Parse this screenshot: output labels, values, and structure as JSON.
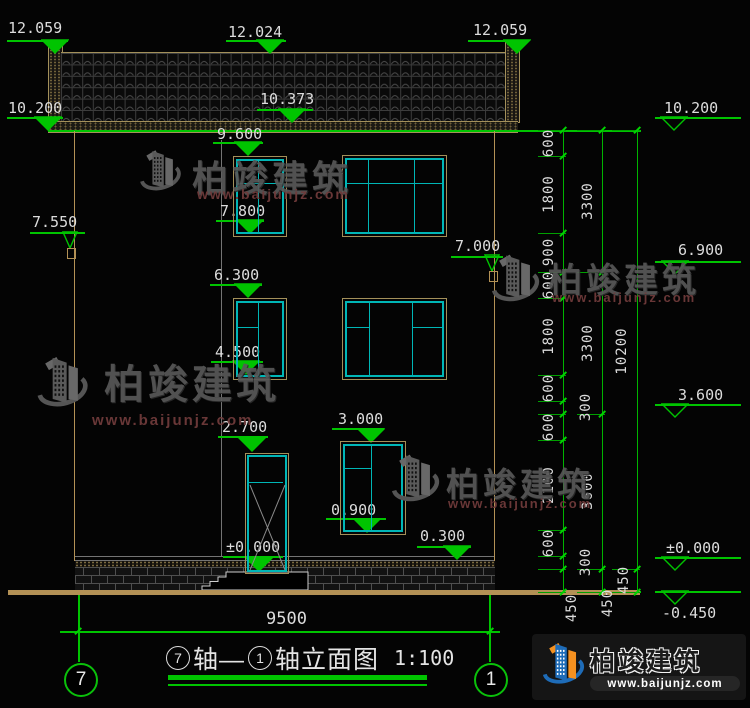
{
  "drawing": {
    "title": {
      "axis_left_num": "7",
      "axis_join": "轴—",
      "axis_right_num": "1",
      "suffix": "轴立面图",
      "scale": "1:100"
    },
    "axis_bubbles": {
      "left": "7",
      "right": "1"
    },
    "bottom_dimension": {
      "total": "9500"
    },
    "logo": {
      "name": "柏竣建筑",
      "url": "www.baijunjz.com"
    },
    "colors": {
      "dim_green": "#00c400",
      "cad_teal": "#00b6b6",
      "frame_tan": "#a3905a",
      "text_white": "#dcdcdc",
      "watermark_gray": "#585858",
      "watermark_red": "#6f3a3a",
      "logo_blue": "#1e6cb8",
      "logo_orange": "#f59120"
    }
  },
  "elevation_markers": [
    {
      "label": "12.059",
      "variant": "filled",
      "tx": 8,
      "ty": 20,
      "lx1": 7,
      "lx2": 68,
      "ly": 40,
      "cx": 55,
      "tip": 53
    },
    {
      "label": "12.024",
      "variant": "filled",
      "tx": 228,
      "ty": 24,
      "lx1": 226,
      "lx2": 286,
      "ly": 40,
      "cx": 270,
      "tip": 53
    },
    {
      "label": "12.059",
      "variant": "filled",
      "tx": 473,
      "ty": 22,
      "lx1": 468,
      "lx2": 526,
      "ly": 40,
      "cx": 517,
      "tip": 53
    },
    {
      "label": "10.200",
      "variant": "filled",
      "tx": 8,
      "ty": 100,
      "lx1": 7,
      "lx2": 63,
      "ly": 117,
      "cx": 48,
      "tip": 130
    },
    {
      "label": "10.373",
      "variant": "filled",
      "tx": 260,
      "ty": 91,
      "lx1": 257,
      "lx2": 313,
      "ly": 109,
      "cx": 292,
      "tip": 122
    },
    {
      "label": "9.600",
      "variant": "filled",
      "tx": 217,
      "ty": 126,
      "lx1": 213,
      "lx2": 263,
      "ly": 142,
      "cx": 248,
      "tip": 155
    },
    {
      "label": "7.800",
      "variant": "filled",
      "tx": 220,
      "ty": 203,
      "lx1": 216,
      "lx2": 264,
      "ly": 220,
      "cx": 250,
      "tip": 233
    },
    {
      "label": "6.300",
      "variant": "filled",
      "tx": 214,
      "ty": 267,
      "lx1": 210,
      "lx2": 262,
      "ly": 284,
      "cx": 248,
      "tip": 297
    },
    {
      "label": "4.500",
      "variant": "filled",
      "tx": 215,
      "ty": 344,
      "lx1": 211,
      "lx2": 263,
      "ly": 361,
      "cx": 246,
      "tip": 374
    },
    {
      "label": "2.700",
      "variant": "filled",
      "tx": 222,
      "ty": 419,
      "lx1": 218,
      "lx2": 268,
      "ly": 436,
      "cx": 252,
      "tip": 451
    },
    {
      "label": "3.000",
      "variant": "filled",
      "tx": 338,
      "ty": 411,
      "lx1": 332,
      "lx2": 384,
      "ly": 428,
      "cx": 371,
      "tip": 442
    },
    {
      "label": "0.900",
      "variant": "filled",
      "tx": 331,
      "ty": 502,
      "lx1": 326,
      "lx2": 386,
      "ly": 518,
      "cx": 367,
      "tip": 532
    },
    {
      "label": "0.300",
      "variant": "filled",
      "tx": 420,
      "ty": 528,
      "lx1": 417,
      "lx2": 471,
      "ly": 546,
      "cx": 457,
      "tip": 559
    },
    {
      "label": "±0.000",
      "variant": "filled",
      "tx": 226,
      "ty": 539,
      "lx1": 223,
      "lx2": 283,
      "ly": 556,
      "cx": 259,
      "tip": 571
    },
    {
      "label": "7.550",
      "variant": "narrow",
      "tx": 32,
      "ty": 214,
      "lx1": 30,
      "lx2": 85,
      "ly": 232,
      "cx": 70,
      "tip": 248,
      "box": true
    },
    {
      "label": "7.000",
      "variant": "narrow",
      "tx": 455,
      "ty": 238,
      "lx1": 451,
      "lx2": 503,
      "ly": 256,
      "cx": 492,
      "tip": 271,
      "box": true
    },
    {
      "label": "10.200",
      "variant": "hollow",
      "tx": 664,
      "ty": 100,
      "lx1": 655,
      "lx2": 741,
      "ly": 117,
      "cx": 674,
      "tip": 130
    },
    {
      "label": "6.900",
      "variant": "hollow",
      "tx": 678,
      "ty": 242,
      "lx1": 655,
      "lx2": 741,
      "ly": 261,
      "cx": 675,
      "tip": 274
    },
    {
      "label": "3.600",
      "variant": "hollow",
      "tx": 678,
      "ty": 387,
      "lx1": 655,
      "lx2": 741,
      "ly": 404,
      "cx": 675,
      "tip": 417
    },
    {
      "label": "±0.000",
      "variant": "hollow",
      "tx": 666,
      "ty": 540,
      "lx1": 655,
      "lx2": 741,
      "ly": 557,
      "cx": 675,
      "tip": 570
    },
    {
      "label": "-0.450",
      "variant": "hollow",
      "tx": 662,
      "ty": 607,
      "lx1": 655,
      "lx2": 741,
      "ly": 591,
      "cx": 675,
      "tip": 604,
      "below": true
    }
  ],
  "dimension_chains": {
    "lines": [
      {
        "x": 563,
        "y1": 130,
        "y2": 592,
        "boundaries": [
          130,
          156,
          233,
          272,
          298,
          375,
          401,
          414,
          440,
          530,
          556,
          569,
          592
        ]
      },
      {
        "x": 602,
        "y1": 130,
        "y2": 592,
        "boundaries": [
          130,
          272,
          414,
          569,
          592
        ]
      },
      {
        "x": 637,
        "y1": 130,
        "y2": 592,
        "boundaries": [
          130,
          569,
          592
        ]
      }
    ],
    "labels": [
      {
        "t": "600",
        "x": 549,
        "y": 143
      },
      {
        "t": "1800",
        "x": 549,
        "y": 194
      },
      {
        "t": "900",
        "x": 549,
        "y": 252
      },
      {
        "t": "600",
        "x": 549,
        "y": 285
      },
      {
        "t": "1800",
        "x": 549,
        "y": 336
      },
      {
        "t": "600",
        "x": 549,
        "y": 388
      },
      {
        "t": "300",
        "x": 586,
        "y": 407
      },
      {
        "t": "600",
        "x": 549,
        "y": 427
      },
      {
        "t": "2100",
        "x": 549,
        "y": 485
      },
      {
        "t": "600",
        "x": 549,
        "y": 543
      },
      {
        "t": "300",
        "x": 586,
        "y": 562
      },
      {
        "t": "450",
        "x": 572,
        "y": 608
      },
      {
        "t": "3300",
        "x": 588,
        "y": 201
      },
      {
        "t": "3300",
        "x": 588,
        "y": 343
      },
      {
        "t": "3600",
        "x": 588,
        "y": 491
      },
      {
        "t": "450",
        "x": 608,
        "y": 603
      },
      {
        "t": "10200",
        "x": 622,
        "y": 351
      },
      {
        "t": "450",
        "x": 624,
        "y": 580
      }
    ]
  },
  "green_lines": [
    {
      "x": 48,
      "y": 130,
      "w": 593,
      "h": 1.5
    },
    {
      "x": 538,
      "y": 591,
      "w": 103,
      "h": 1.5
    },
    {
      "x": 60,
      "y": 631,
      "w": 440,
      "h": 1.5
    },
    {
      "x": 78,
      "y": 595,
      "w": 1.5,
      "h": 67
    },
    {
      "x": 489,
      "y": 595,
      "w": 1.5,
      "h": 67
    },
    {
      "x": 168,
      "y": 675,
      "w": 259,
      "h": 5
    },
    {
      "x": 168,
      "y": 684,
      "w": 259,
      "h": 2
    }
  ],
  "white_lines": [
    {
      "x": 75,
      "y": 556,
      "w": 420,
      "h": 1.2
    },
    {
      "x": 75,
      "y": 560,
      "w": 420,
      "h": 1.2
    },
    {
      "x": 221,
      "y": 140,
      "w": 1,
      "h": 416
    }
  ],
  "tan_lines": [
    {
      "x": 74,
      "y": 131,
      "w": 1.2,
      "h": 430
    },
    {
      "x": 494,
      "y": 131,
      "w": 1.2,
      "h": 430
    },
    {
      "x": 8,
      "y": 590,
      "w": 632,
      "h": 4.5
    }
  ],
  "dim_slashes": [
    {
      "x": 78,
      "y": 631
    },
    {
      "x": 490,
      "y": 631
    }
  ],
  "windows": [
    {
      "frame": [
        233,
        156,
        52,
        79
      ],
      "lines": [
        [
          258,
          159,
          1.4,
          73
        ],
        [
          236,
          183,
          46,
          1.4
        ]
      ]
    },
    {
      "frame": [
        342,
        155,
        103,
        80
      ],
      "lines": [
        [
          368,
          158,
          1.4,
          74
        ],
        [
          414,
          158,
          1.4,
          74
        ],
        [
          345,
          183,
          97,
          1.4
        ]
      ]
    },
    {
      "frame": [
        233,
        298,
        52,
        80
      ],
      "lines": [
        [
          258,
          301,
          1.4,
          74
        ],
        [
          236,
          327,
          23,
          1.4
        ]
      ]
    },
    {
      "frame": [
        342,
        298,
        103,
        80
      ],
      "lines": [
        [
          369,
          301,
          1.4,
          74
        ],
        [
          412,
          301,
          1.4,
          74
        ],
        [
          345,
          327,
          25,
          1.4
        ],
        [
          413,
          327,
          29,
          1.4
        ]
      ]
    },
    {
      "frame": [
        340,
        441,
        64,
        92
      ],
      "lines": [
        [
          371,
          444,
          1.4,
          86
        ],
        [
          343,
          468,
          29,
          1.4
        ]
      ]
    }
  ],
  "door": {
    "frame": [
      245,
      453,
      42,
      119
    ],
    "transom": [
      249,
      482,
      34,
      1.4
    ],
    "diagonals": [
      [
        4,
        31,
        39,
        116
      ],
      [
        39,
        31,
        4,
        116
      ]
    ]
  },
  "watermarks": [
    {
      "icon": [
        134,
        148,
        52,
        50
      ],
      "name": "柏竣建筑",
      "url": "www.baijunjz.com",
      "nx": 192,
      "ny": 150,
      "nfs": 36,
      "ux": 197,
      "uy": 186,
      "ufs": 14
    },
    {
      "icon": [
        34,
        348,
        56,
        74
      ],
      "name": "柏竣建筑",
      "url": "www.baijunjz.com",
      "nx": 104,
      "ny": 352,
      "nfs": 40,
      "ux": 92,
      "uy": 412,
      "ufs": 15
    },
    {
      "icon": [
        488,
        252,
        54,
        58
      ],
      "name": "柏竣建筑",
      "url": "www.baijunjz.com",
      "nx": 548,
      "ny": 253,
      "nfs": 34,
      "ux": 552,
      "uy": 290,
      "ufs": 13
    },
    {
      "icon": [
        388,
        452,
        54,
        58
      ],
      "name": "柏竣建筑",
      "url": "www.baijunjz.com",
      "nx": 446,
      "ny": 458,
      "nfs": 33,
      "ux": 448,
      "uy": 496,
      "ufs": 13
    }
  ]
}
